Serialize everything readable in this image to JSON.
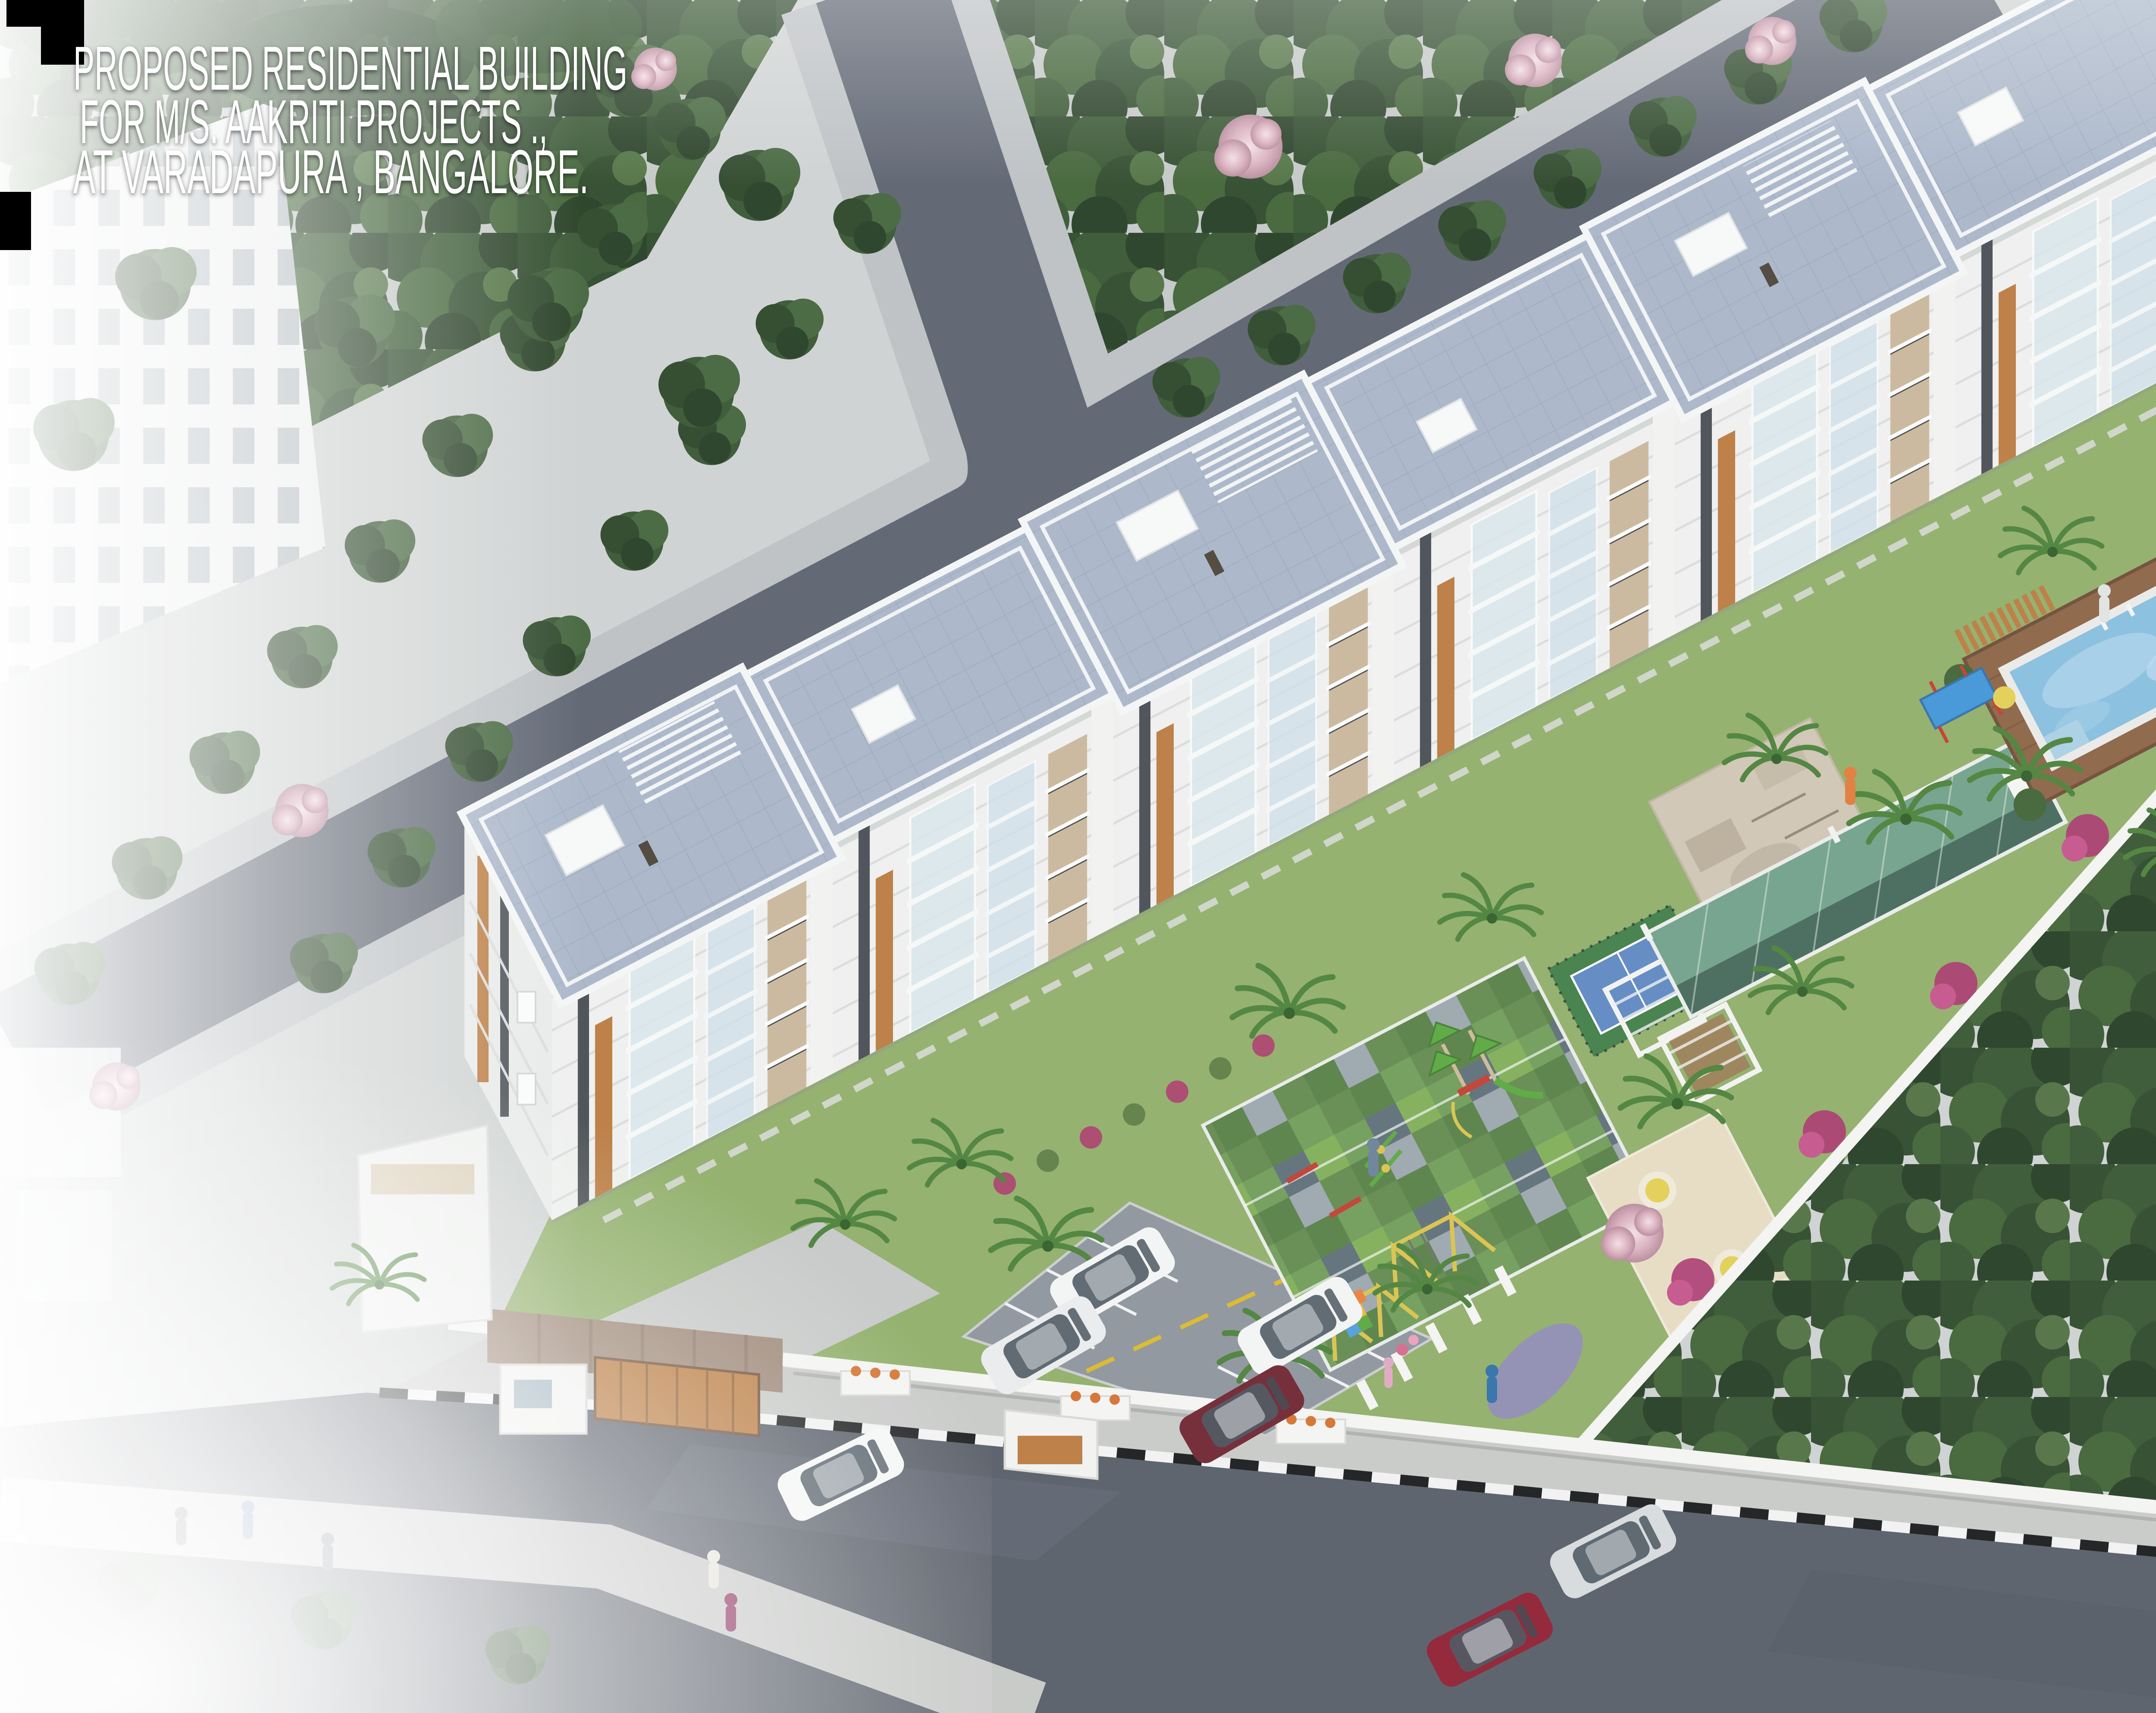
{
  "title": {
    "line1": "PROPOSED RESIDENTIAL BUILDING",
    "line2": "FOR M/S. AAKRITI  PROJECTS .,",
    "line3": "AT VARADAPURA , BANGALORE."
  },
  "logo": {
    "brand": "yukti",
    "separator": "|",
    "services": [
      "Architecture",
      "Engineering",
      "Interiors"
    ],
    "address": "#1148, 22nd Cross, B.S.K-2nd Stage, Bangalore-560070.",
    "contact": "Tel :+91 9845811887 /+91 80-26713029, email: yuktivs@gmail.com"
  },
  "scene": {
    "colors": {
      "gravel": "#ced1d1",
      "forest_green": "#2c4829",
      "blossom_pink": "#d9aebc",
      "road": "#5a616e",
      "asphalt": "#565c66",
      "sidewalk": "#bcc0c3",
      "roof_blue_gray": "#a8b5c8",
      "facade_white": "#eef0ee",
      "wall_white": "#f4f4f2",
      "lawn": "#8fae68",
      "pool_water": "#85bede",
      "deck_wood": "#8a6243",
      "court_blue": "#5d87c2",
      "court_green": "#3f7d46",
      "checker_green": "#6e9c58",
      "sand": "#e6dbc2",
      "accent_wood": "#b97a3e",
      "gate_brown": "#9b8574",
      "swing_yellow": "#d8c24a",
      "bench_red": "#c23b2e",
      "car_red": "#8f1d30",
      "logo_red": "#e8001c",
      "logo_figure_blue": "#b5cfdd"
    }
  }
}
